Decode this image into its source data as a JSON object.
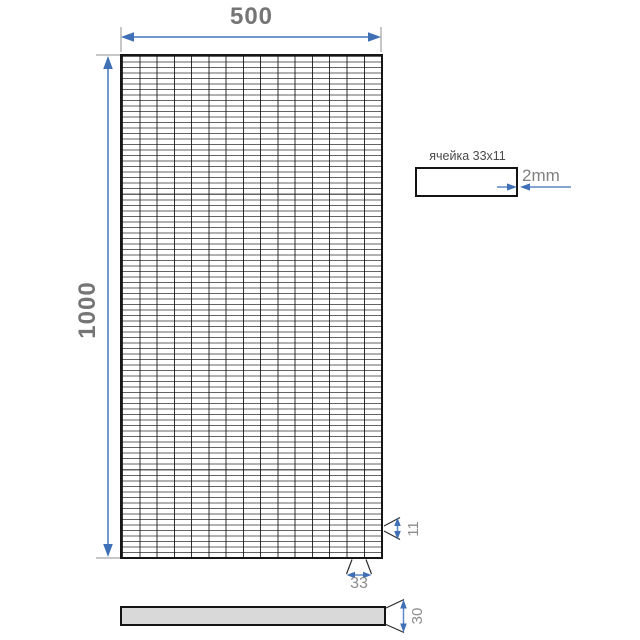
{
  "drawing": {
    "type": "technical-drawing",
    "subject": "wire mesh panel",
    "front_view": {
      "columns": 15,
      "rows": 91
    },
    "dimensions": {
      "width": "500",
      "height": "1000",
      "cell_width": "33",
      "cell_height": "11",
      "wire": "2mm",
      "thickness": "30"
    },
    "cell_detail": {
      "label": "ячейка 33x11"
    },
    "colors": {
      "dim_blue": "#5b87c6",
      "arrow_blue": "#3f6fb5",
      "ext_gray": "#8f8f8f",
      "fan_black": "#2c2c2c",
      "text_gray": "#757575",
      "text_gray_light": "#8c8c8c",
      "grid_line": "#161616",
      "bar_fill": "#d9d9d9"
    }
  }
}
